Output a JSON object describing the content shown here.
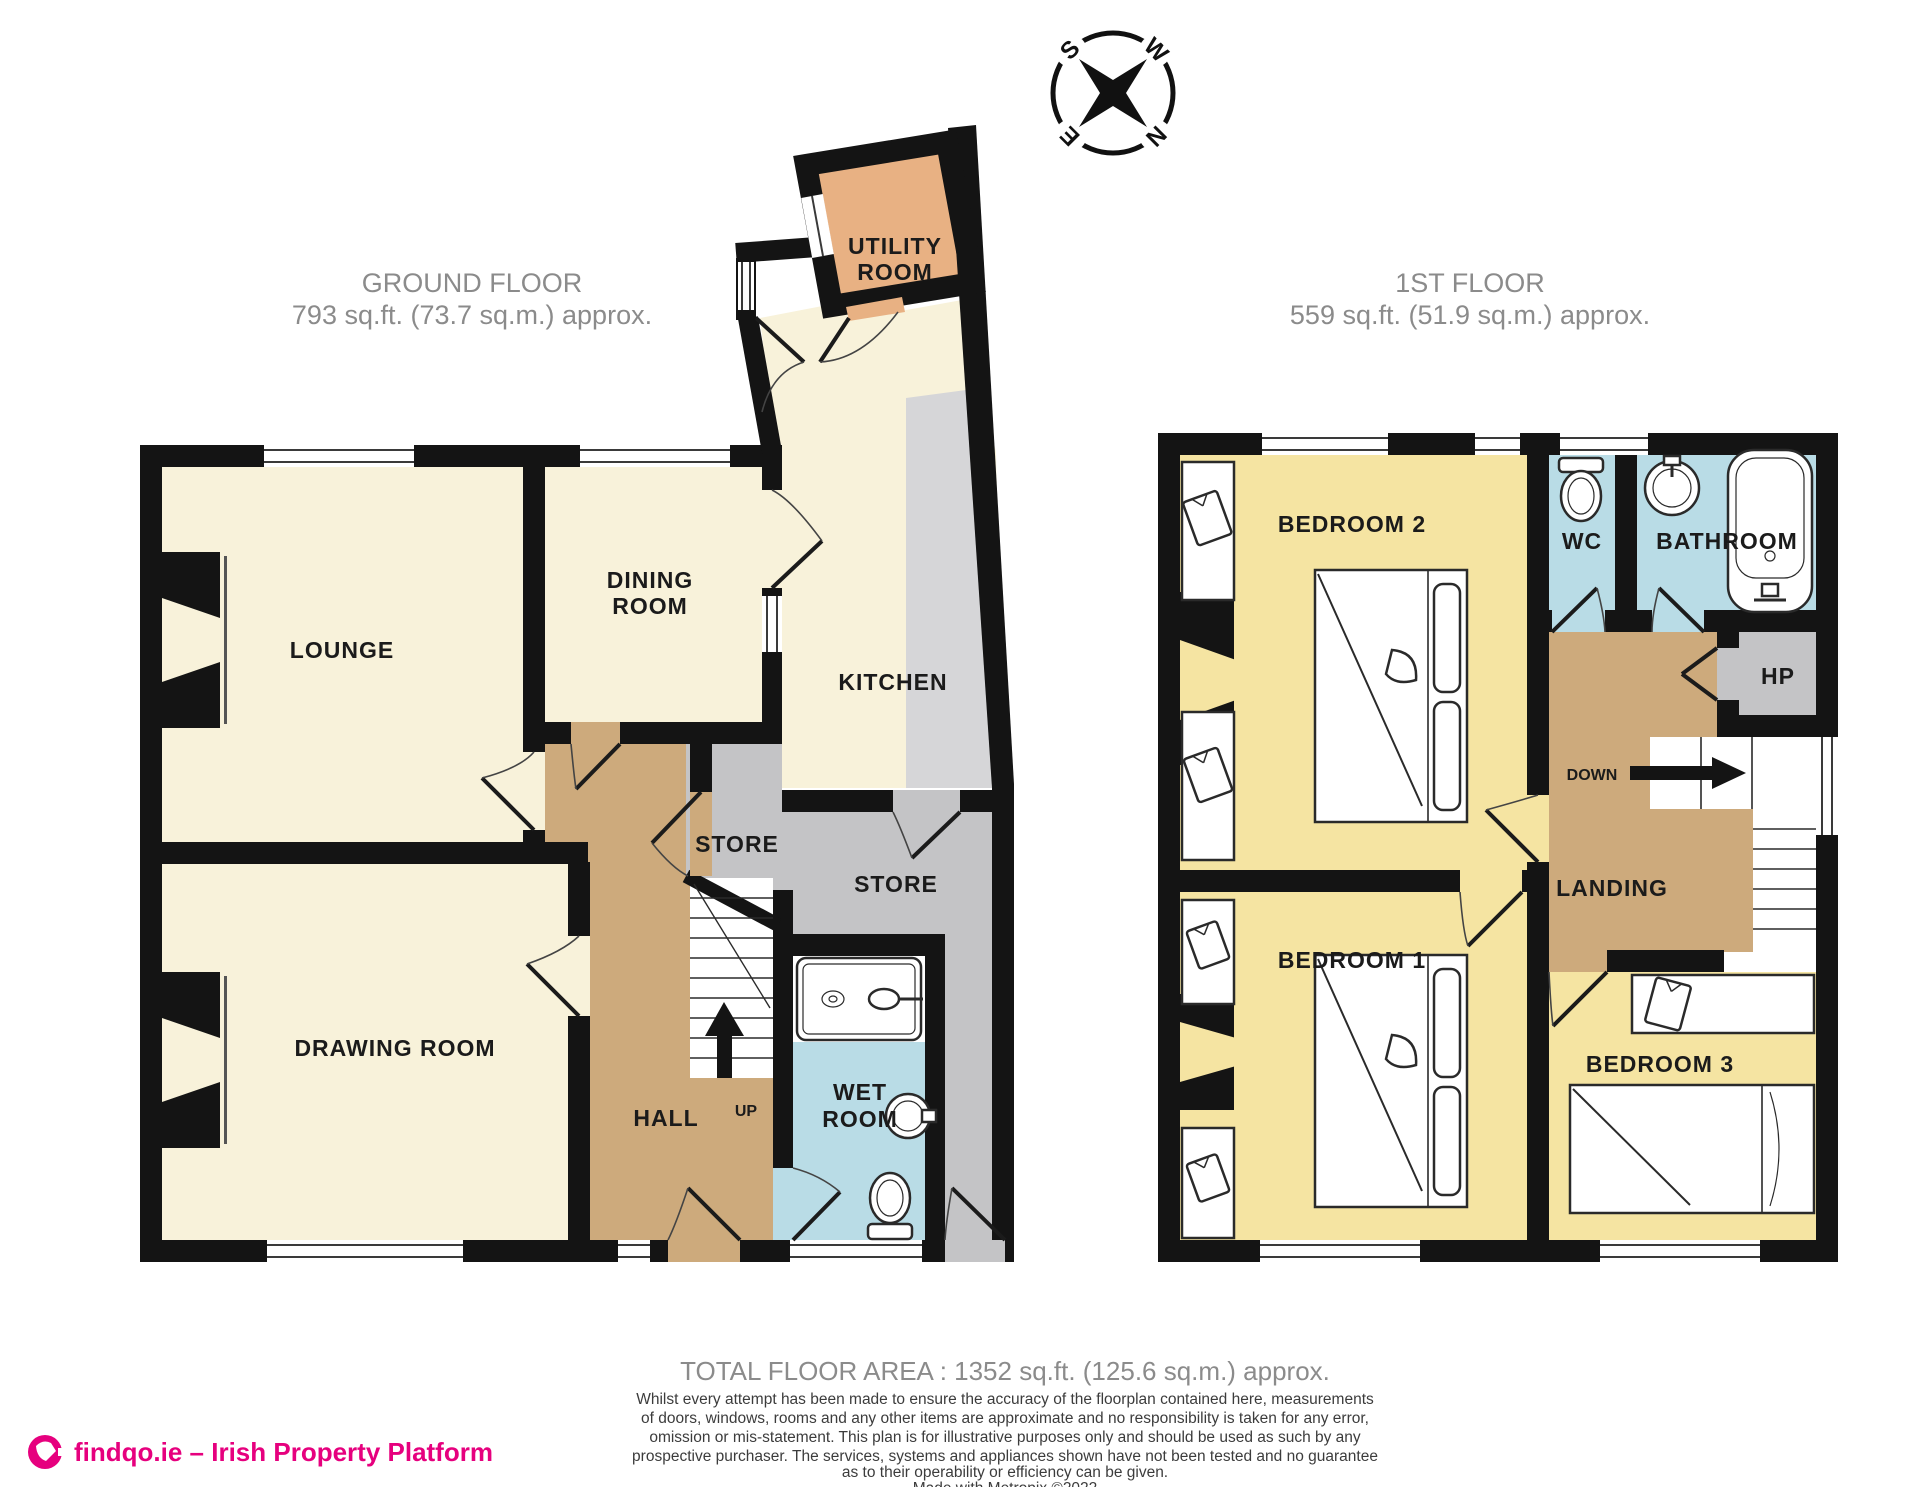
{
  "compass": {
    "n": "N",
    "e": "E",
    "s": "S",
    "w": "W"
  },
  "floors": {
    "ground": {
      "title": "GROUND FLOOR",
      "area": "793 sq.ft. (73.7 sq.m.) approx."
    },
    "first": {
      "title": "1ST FLOOR",
      "area": "559 sq.ft. (51.9 sq.m.) approx."
    }
  },
  "rooms": {
    "ground": {
      "lounge": "LOUNGE",
      "dining_1": "DINING",
      "dining_2": "ROOM",
      "kitchen": "KITCHEN",
      "utility_1": "UTILITY",
      "utility_2": "ROOM",
      "store_small": "STORE",
      "store_large": "STORE",
      "drawing_room": "DRAWING ROOM",
      "hall": "HALL",
      "up": "UP",
      "wet_1": "WET",
      "wet_2": "ROOM"
    },
    "first": {
      "bedroom2": "BEDROOM 2",
      "wc": "WC",
      "bathroom": "BATHROOM",
      "hp": "HP",
      "down": "DOWN",
      "landing": "LANDING",
      "bedroom1": "BEDROOM 1",
      "bedroom3": "BEDROOM 3"
    }
  },
  "footer": {
    "total": "TOTAL FLOOR AREA : 1352 sq.ft. (125.6 sq.m.) approx.",
    "disclaimer": [
      "Whilst every attempt has been made to ensure the accuracy of the floorplan contained here, measurements",
      "of doors, windows, rooms and any other items are approximate and no responsibility is taken for any error,",
      "omission or mis-statement. This plan is for illustrative purposes only and should be used as such by any",
      "prospective purchaser. The services, systems and appliances shown have not been tested and no guarantee",
      "as to their operability or efficiency can be given."
    ],
    "credit": "Made with Metropix ©2022"
  },
  "branding": {
    "logo_text": "findqo.ie – Irish Property Platform",
    "brand_color": "#e6007e"
  },
  "colors": {
    "room_cream": "#f8f2da",
    "hall_tan": "#cdaa7c",
    "bedroom_yellow": "#f5e4a2",
    "wet_blue": "#b9dce6",
    "utility_orange": "#e8b183",
    "store_grey": "#c4c4c6",
    "counter_grey": "#d6d6d8",
    "wall": "#141414",
    "heading_grey": "#8b8b8b"
  }
}
